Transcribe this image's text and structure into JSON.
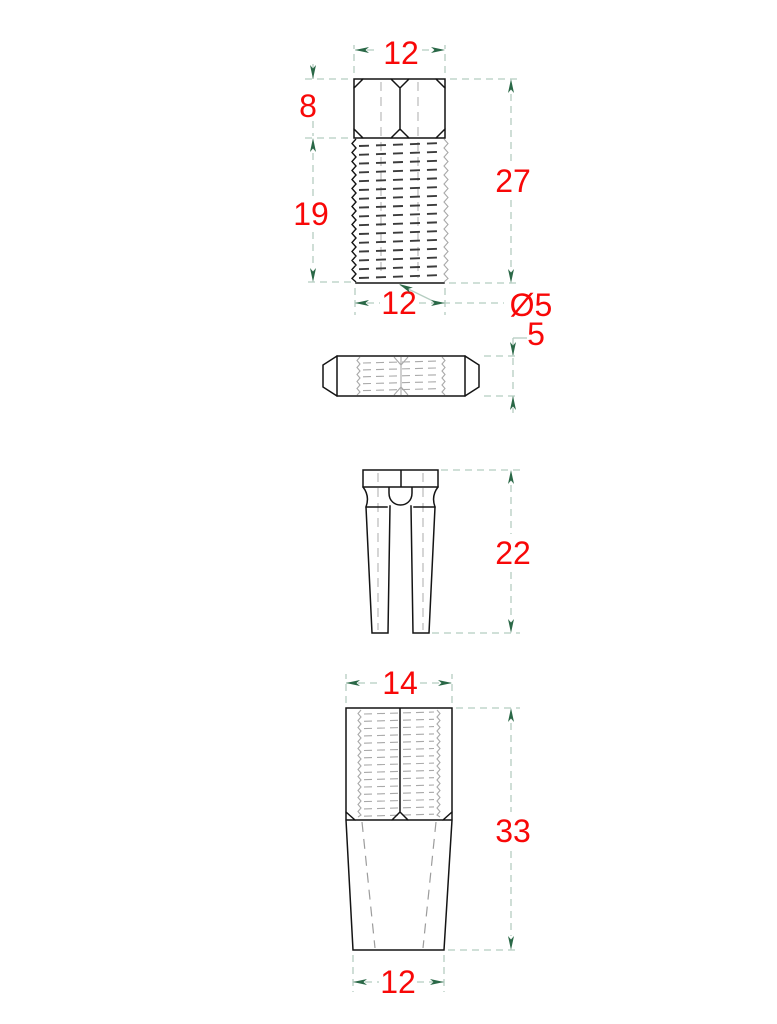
{
  "drawing": {
    "background": "#ffffff",
    "colors": {
      "outline": "#141414",
      "dimension_line": "#b5cdc1",
      "arrow": "#2a6847",
      "dimension_text": "#f80808",
      "thread_dark": "#3c3c3c",
      "thread_light": "#a9a9a9",
      "hidden_line": "#9c9c9c",
      "centerline_light": "#b3b3b3"
    },
    "views": {
      "stud_front": {
        "dims": {
          "top_width": "12",
          "head_height": "8",
          "thread_length": "19",
          "total_length": "27",
          "bottom_width": "12",
          "diameter": "Ø5"
        }
      },
      "stud_side": {
        "dims": {
          "height": "5"
        }
      },
      "wedge": {
        "dims": {
          "length": "22"
        }
      },
      "sleeve": {
        "dims": {
          "top_width": "14",
          "length": "33",
          "bottom_width": "12"
        }
      }
    }
  }
}
